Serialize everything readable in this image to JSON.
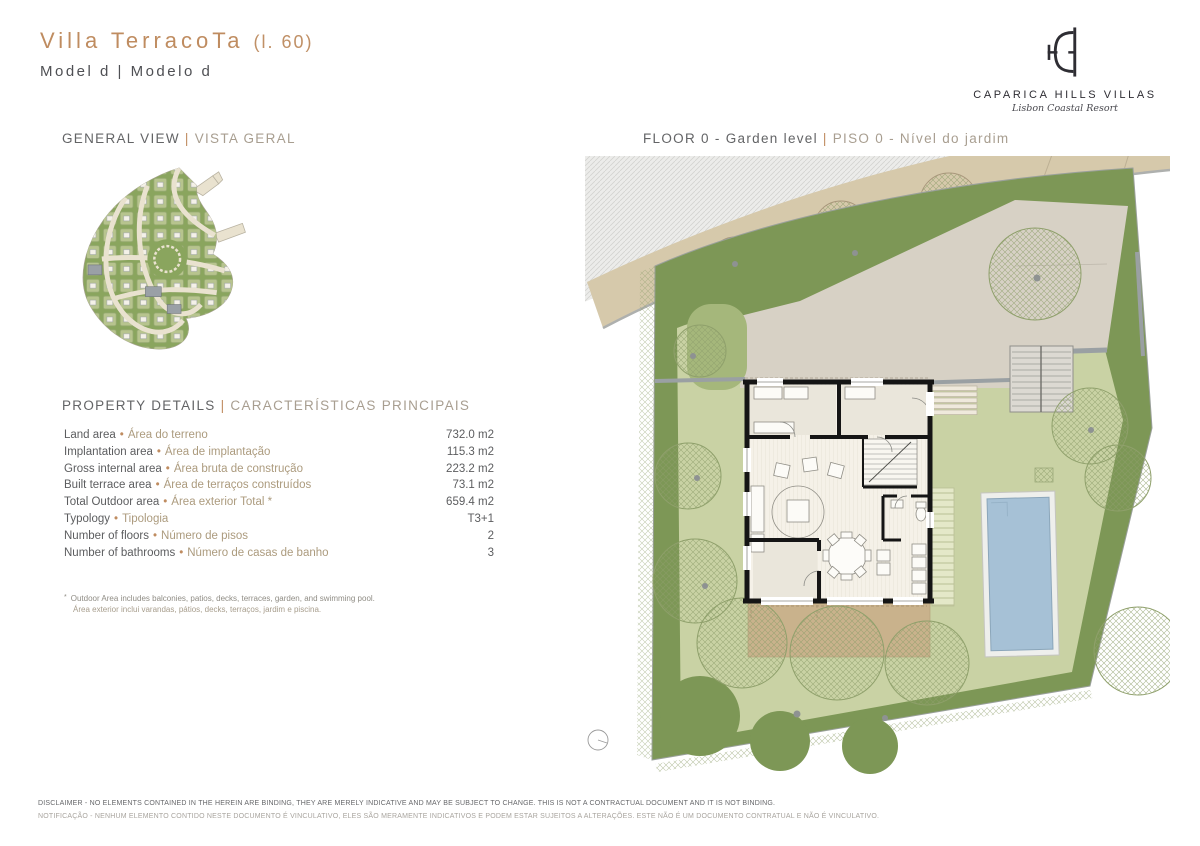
{
  "ui": {
    "bullet": "•",
    "pipe": "|",
    "footnote_marker": "*"
  },
  "header": {
    "title": "Villa TerracoTa",
    "lot_number": "(l. 60)",
    "model": "Model d | Modelo d",
    "logo": {
      "name": "CAPARICA HILLS VILLAS",
      "tagline": "Lisbon Coastal Resort"
    }
  },
  "sections": {
    "general_view": {
      "en": "GENERAL VIEW",
      "pt": "VISTA GERAL"
    },
    "floor": {
      "en": "FLOOR 0 - Garden level",
      "pt": "PISO 0 - Nível do jardim"
    },
    "property_details": {
      "en": "PROPERTY DETAILS",
      "pt": "CARACTERÍSTICAS PRINCIPAIS"
    }
  },
  "details": [
    {
      "label_en": "Land area",
      "label_pt": "Área do terreno",
      "value": "732.0 m2"
    },
    {
      "label_en": "Implantation area",
      "label_pt": "Área de implantação",
      "value": "115.3 m2"
    },
    {
      "label_en": "Gross internal area",
      "label_pt": "Área bruta de construção",
      "value": "223.2 m2"
    },
    {
      "label_en": "Built terrace area",
      "label_pt": "Área de terraços construídos",
      "value": "73.1 m2"
    },
    {
      "label_en": "Total Outdoor area",
      "label_pt": "Área exterior Total *",
      "value": "659.4 m2"
    },
    {
      "label_en": "Typology",
      "label_pt": "Tipologia",
      "value": "T3+1"
    },
    {
      "label_en": "Number of floors",
      "label_pt": "Número de pisos",
      "value": "2"
    },
    {
      "label_en": "Number of bathrooms",
      "label_pt": "Número de casas de banho",
      "value": "3"
    }
  ],
  "footnote": {
    "en": "Outdoor Area includes balconies, patios, decks, terraces, garden, and swimming pool.",
    "pt": "Área exterior inclui varandas, pátios, decks, terraços, jardim e piscina."
  },
  "disclaimer": {
    "en": "DISCLAIMER - NO ELEMENTS CONTAINED IN THE HEREIN ARE BINDING, THEY ARE MERELY INDICATIVE AND MAY BE SUBJECT TO CHANGE. THIS IS NOT A CONTRACTUAL DOCUMENT AND IT IS NOT BINDING.",
    "pt": "NOTIFICAÇÃO - NENHUM ELEMENTO CONTIDO NESTE DOCUMENTO É VINCULATIVO, ELES SÃO MERAMENTE INDICATIVOS E PODEM ESTAR SUJEITOS A ALTERAÇÕES. ESTE NÃO É UM DOCUMENTO CONTRATUAL E NÃO É VINCULATIVO."
  },
  "colors": {
    "accent_terracotta": "#bf8c60",
    "text_dark": "#58595b",
    "text_tan": "#ac9b7e",
    "plan_dark_green": "#7d9756",
    "plan_light_green": "#c9d2a4",
    "plan_medium_green": "#a5b77b",
    "road_beige": "#d6c9ab",
    "forecourt_gray": "#d7d1c5",
    "terrace_tan": "#c9b28c",
    "pool_blue": "#a6c1d6",
    "wall_black": "#151515",
    "logo_dark": "#2e2d33"
  }
}
